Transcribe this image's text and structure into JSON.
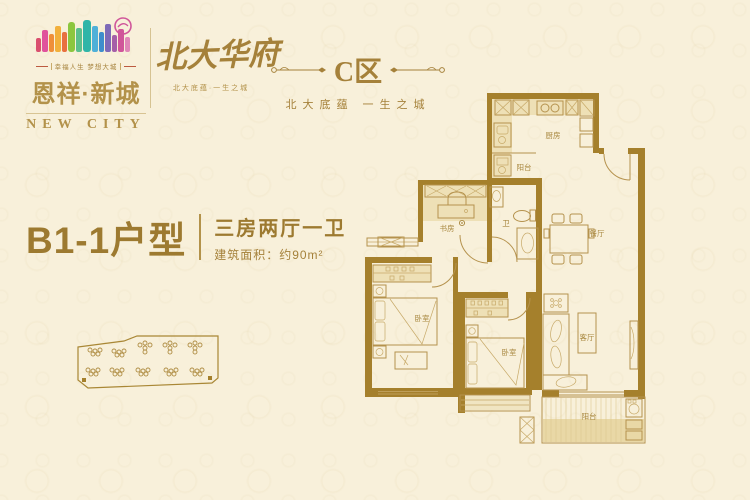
{
  "brand": {
    "name": "恩祥·新城",
    "name_en": "NEW CITY",
    "tagline": "幸福人生 梦想大城",
    "project_name": "北大华府",
    "project_tagline": "北大底蕴·一生之城"
  },
  "zone": {
    "label": "C区",
    "subtitle": "北大底蕴 一生之城"
  },
  "unit": {
    "name": "B1-1户型",
    "rooms": "三房两厅一卫",
    "area": "建筑面积：约90m²"
  },
  "floorplan": {
    "kitchen": "厨房",
    "service_balcony": "阳台",
    "study": "书房",
    "bathroom": "卫",
    "dining": "餐厅",
    "bedroom_left": "卧室",
    "bedroom_middle": "卧室",
    "living": "客厅",
    "balcony": "阳台"
  },
  "colors": {
    "gold": "#a5813a",
    "wall_brown": "#a5802c",
    "light_fill": "#eee0b6",
    "background": "#f8f0da",
    "accent_red": "#bc5a40"
  }
}
